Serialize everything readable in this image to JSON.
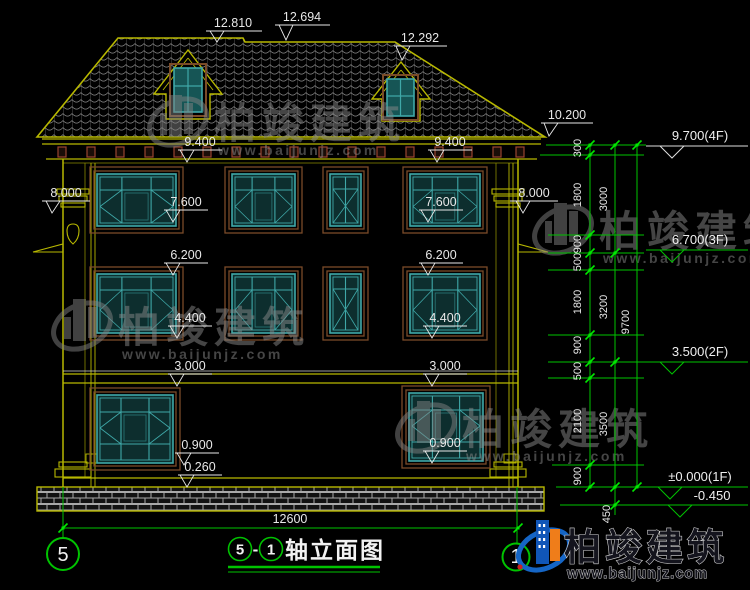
{
  "watermark": {
    "brand": "柏竣建筑",
    "url": "www.baijunjz.com"
  },
  "logo": {
    "brand": "柏竣建筑",
    "url": "www.baijunjz.com"
  },
  "title": {
    "axis_left": "5",
    "separator": "-",
    "axis_right": "1",
    "label": "轴立面图"
  },
  "axis_bubbles": {
    "left": "5",
    "right": "1"
  },
  "roof_dims": {
    "ridge_main": "12.810",
    "ridge_mid": "12.694",
    "ridge_right": "12.292",
    "eave_right": "10.200"
  },
  "elev_labels": {
    "v9400": "9.400",
    "v8000": "8.000",
    "v7600": "7.600",
    "v6200": "6.200",
    "v4400": "4.400",
    "v3000": "3.000",
    "v0900": "0.900",
    "v0260": "0.260"
  },
  "floor_levels": {
    "f4": "9.700(4F)",
    "f3": "6.700(3F)",
    "f2": "3.500(2F)",
    "f1": "±0.000(1F)",
    "ground": "-0.450"
  },
  "dim_chain_small": [
    "300",
    "1800",
    "900",
    "500",
    "1800",
    "900",
    "500",
    "2100",
    "900"
  ],
  "dim_chain_mid": [
    "3000",
    "3200",
    "3500"
  ],
  "dim_total_height": "9700",
  "dim_foundation": "450",
  "dim_total_width": "12600",
  "colors": {
    "cad_yellow": "#b8b800",
    "cad_green": "#00c300",
    "window_teal": "#3fa8a8",
    "frame_brown": "#7a4b28",
    "logo_blue": "#1056b8",
    "logo_orange": "#ef7d1a"
  }
}
